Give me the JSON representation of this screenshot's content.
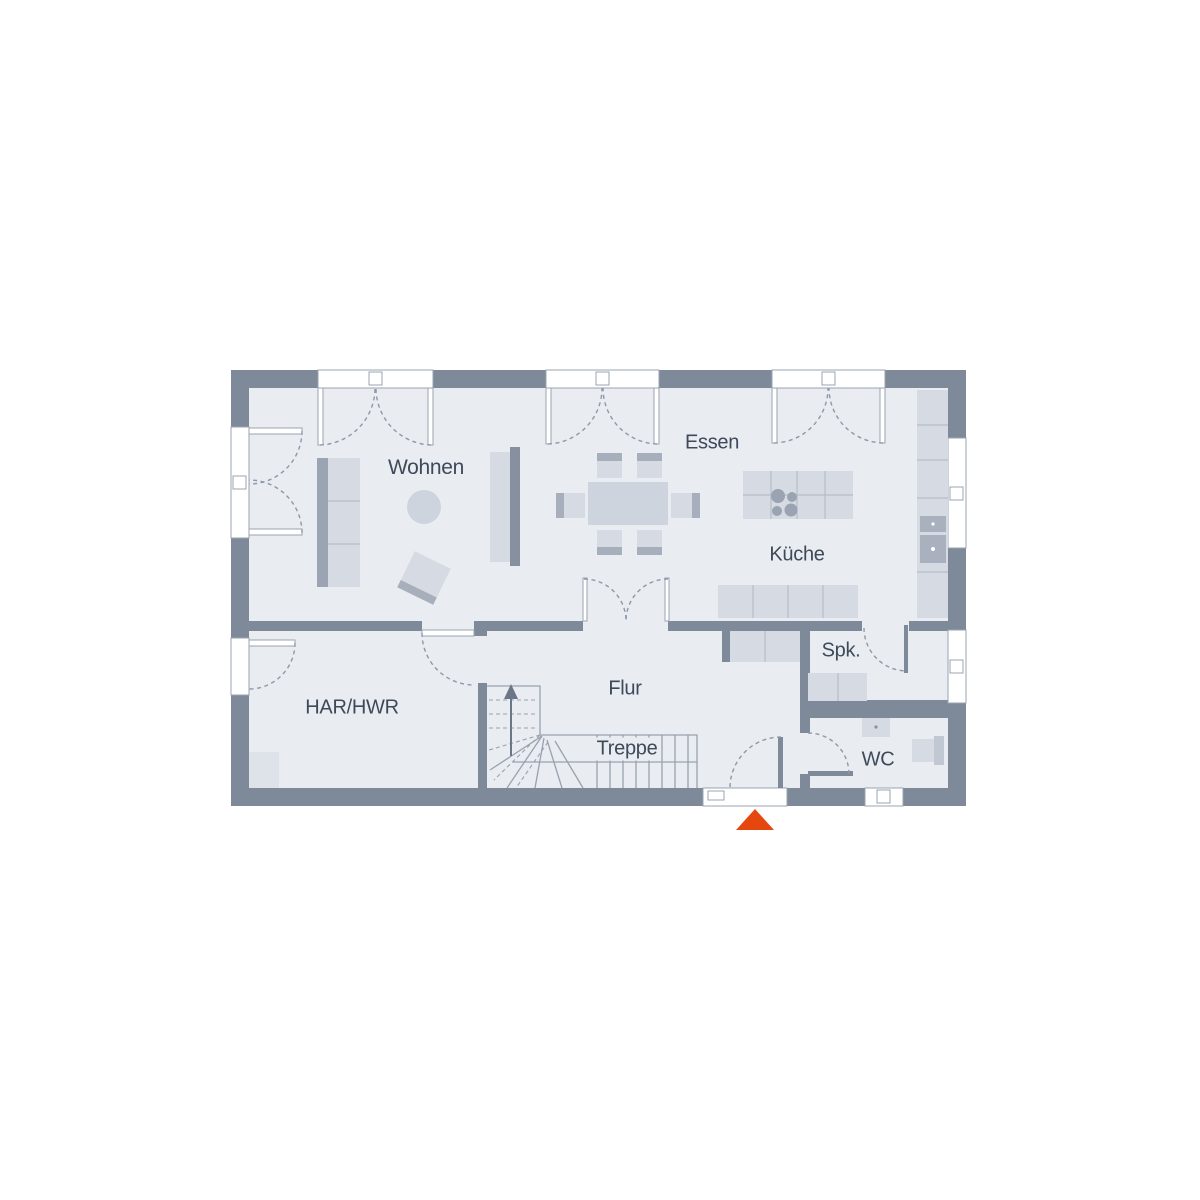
{
  "rooms": {
    "wohnen": {
      "label": "Wohnen"
    },
    "essen": {
      "label": "Essen"
    },
    "kueche": {
      "label": "Küche"
    },
    "spk": {
      "label": "Spk."
    },
    "flur": {
      "label": "Flur"
    },
    "treppe": {
      "label": "Treppe"
    },
    "har_hwr": {
      "label": "HAR/HWR"
    },
    "wc": {
      "label": "WC"
    }
  },
  "icons": {
    "entrance_arrow": "filled-triangle-up",
    "stairs_direction_arrow": "arrow-up"
  },
  "colors": {
    "wall": "#7E8A9A",
    "floor": "#E9ECF1",
    "window": "#FFFFFF",
    "window_frame": "#9AA4B1",
    "furniture": "#D6DBE3",
    "furniture_mid": "#CED4DD",
    "furniture_dark": "#9BA4B3",
    "chair_back": "#A7AFBC",
    "line": "#B6BDC8",
    "outline": "#97A2B0",
    "arc": "#8D99A9",
    "text": "#3E4A5A",
    "accent": "#E5470E",
    "arrow_dark": "#6B7787",
    "appliance": "#A9B1BE",
    "soft": "#DEE2E9"
  }
}
